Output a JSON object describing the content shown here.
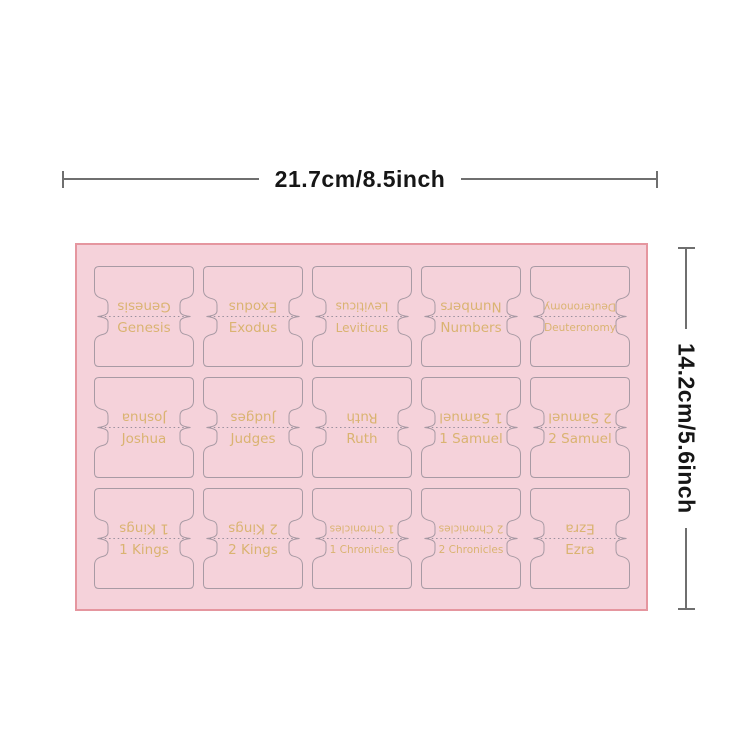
{
  "rulers": {
    "width": {
      "label": "21.7cm/8.5inch"
    },
    "height": {
      "label": "14.2cm/5.6inch"
    },
    "line_color": "#6f6f6f",
    "text_color": "#161616"
  },
  "sheet": {
    "fill": "#f5d2da",
    "border_color": "#e5969f",
    "cut_line_color": "#a89aa4",
    "fold_line_color": "#9a8f9d",
    "label_color": "#d8b169",
    "grid": {
      "rows": 3,
      "cols": 5
    },
    "tabs": [
      {
        "label": "Genesis"
      },
      {
        "label": "Exodus"
      },
      {
        "label": "Leviticus"
      },
      {
        "label": "Numbers"
      },
      {
        "label": "Deuteronomy"
      },
      {
        "label": "Joshua"
      },
      {
        "label": "Judges"
      },
      {
        "label": "Ruth"
      },
      {
        "label": "1 Samuel"
      },
      {
        "label": "2 Samuel"
      },
      {
        "label": "1 Kings"
      },
      {
        "label": "2 Kings"
      },
      {
        "label": "1 Chronicles"
      },
      {
        "label": "2 Chronicles"
      },
      {
        "label": "Ezra"
      }
    ]
  }
}
